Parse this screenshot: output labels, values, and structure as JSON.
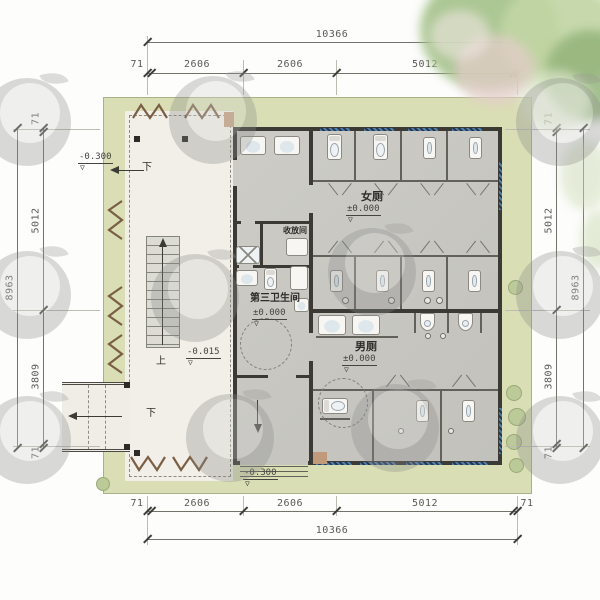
{
  "drawing": {
    "type": "architectural-floor-plan",
    "rooms": {
      "women": {
        "label": "女厕",
        "elev": "±0.000"
      },
      "men": {
        "label": "男厕",
        "elev": "±0.000"
      },
      "third": {
        "label": "第三卫生间",
        "elev": "±0.000"
      },
      "storage": {
        "label": "收放间"
      }
    },
    "levels": {
      "upper_left_path": "-0.300",
      "stair_landing": "-0.015",
      "entrance": "-0.300"
    },
    "flow": {
      "up": "上",
      "down": "下"
    },
    "dims": {
      "top": {
        "overall": "10366",
        "segs": [
          "71",
          "2606",
          "2606",
          "5012",
          "71"
        ]
      },
      "bottom": {
        "overall": "10366",
        "segs": [
          "71",
          "2606",
          "2606",
          "5012",
          "71"
        ]
      },
      "left": {
        "overall": "8963",
        "segs": [
          "71",
          "5012",
          "3809",
          "71"
        ]
      },
      "right": {
        "overall": "8963",
        "segs": [
          "71",
          "5012",
          "3809",
          "71"
        ]
      }
    },
    "symbols": {
      "level_triangle": "▽"
    },
    "colors": {
      "site_green": "#d9deb4",
      "wall_dark": "#3b3a35",
      "floor_gray": "#c9c8c2",
      "porch_cream": "#f1efe7",
      "window_blue": "#4d7fae",
      "trellis_brown": "#7a5f46"
    }
  }
}
